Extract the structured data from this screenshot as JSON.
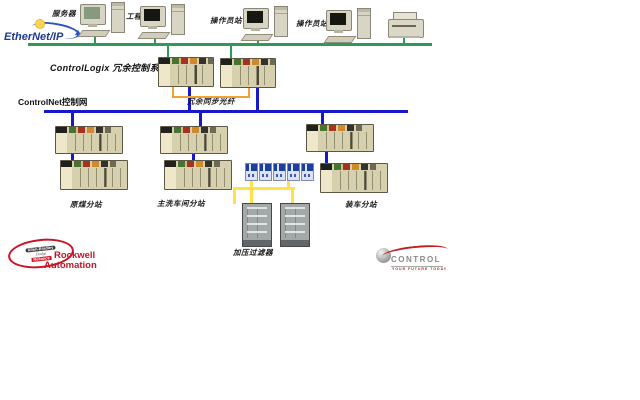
{
  "ethernet_ip": {
    "logo_text": "EtherNet/IP"
  },
  "controlnet": {
    "label": "ControlNet控制网"
  },
  "workstations": {
    "server": "服务器",
    "engineer": "工程师站",
    "operator1": "操作员站",
    "operator2": "操作员站"
  },
  "controllogix": {
    "system_label": "ControlLogix 冗余控制系统",
    "fiber_label": "冗余同步光纤"
  },
  "substations": {
    "left": "原煤分站",
    "middle": "主洗车间分站",
    "right": "装车分站"
  },
  "filter": {
    "label": "加压过滤器"
  },
  "logos": {
    "rockwell": {
      "line1": "Rockwell",
      "line2": "Automation",
      "brands": [
        "Allen-Bradley",
        "Dodge",
        "Reliance"
      ]
    },
    "control": {
      "name": "CONTROL",
      "tagline": "YOUR FUTURE TODAY"
    }
  },
  "colors": {
    "ethernet_bus": "#2d9b57",
    "controlnet_bus": "#1718c9",
    "fiber_bracket": "#f0a232",
    "device_link": "#ffe24a",
    "ethernet_logo_blue": "#1d3a8f",
    "rockwell_red": "#c81423"
  }
}
